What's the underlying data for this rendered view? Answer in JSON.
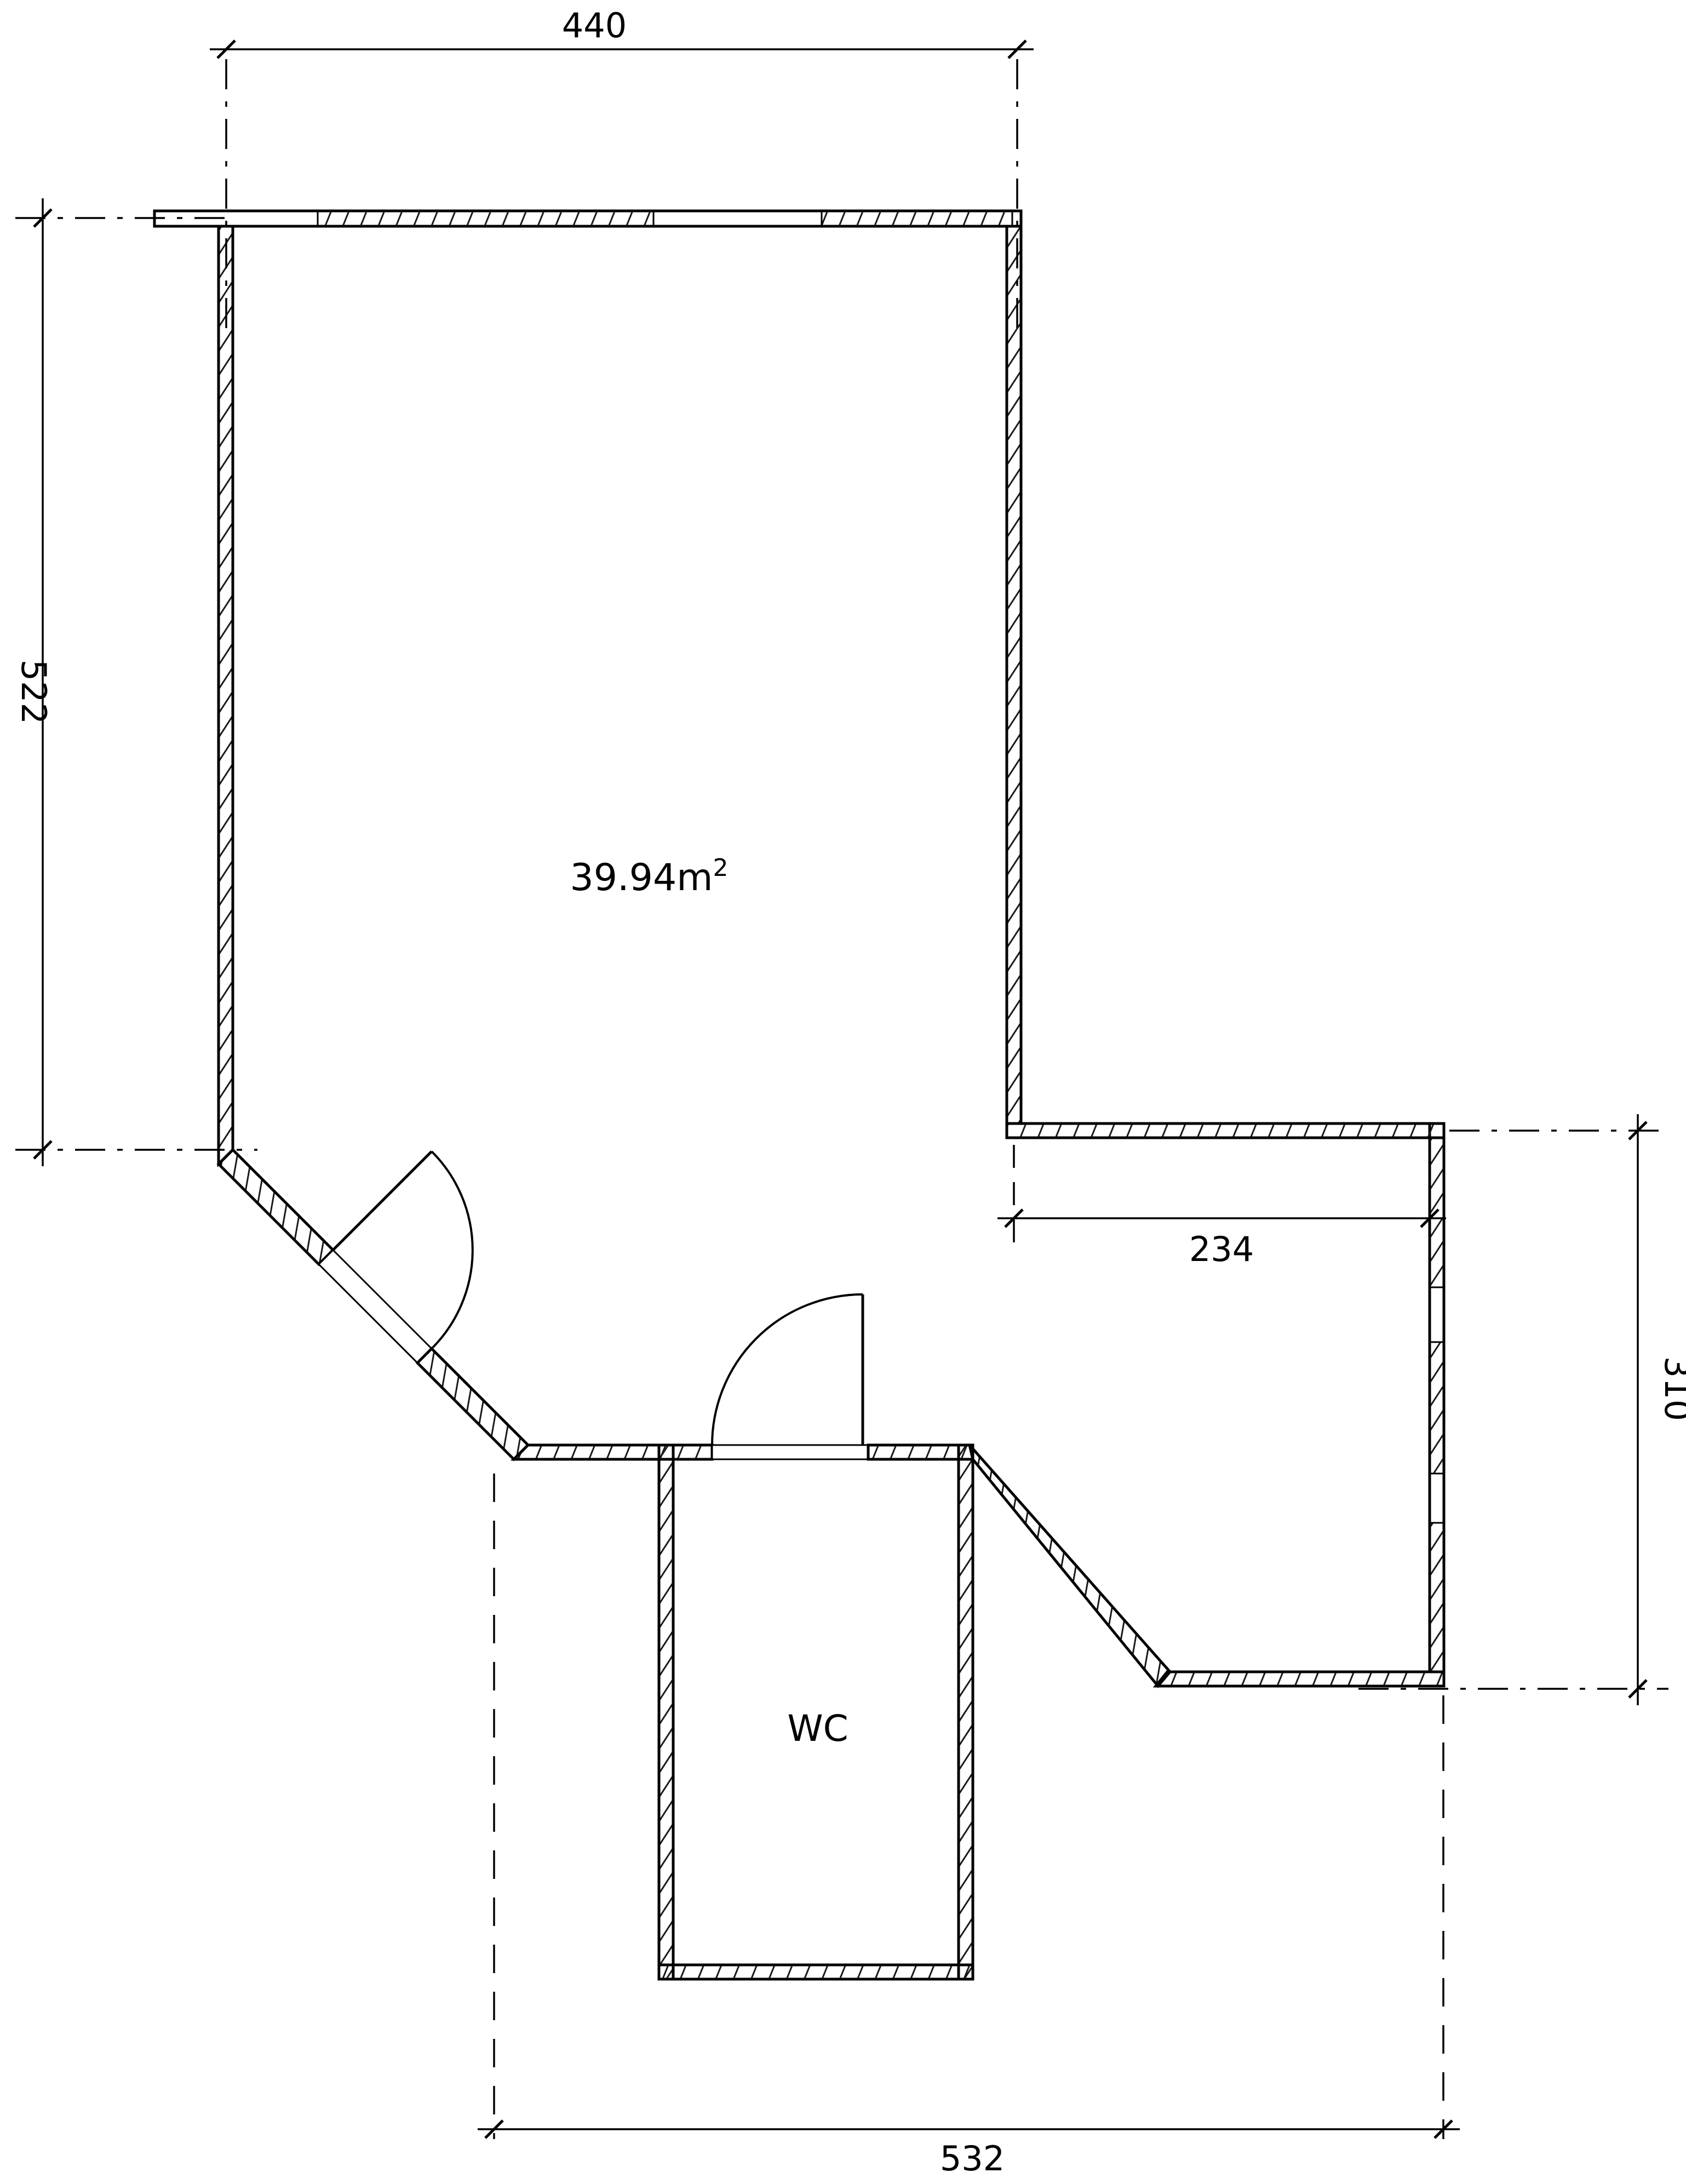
{
  "drawing": {
    "type": "architectural-floor-plan",
    "area_label": {
      "text": "39.94m",
      "sup": "2"
    },
    "room_label": "WC",
    "dimensions": {
      "top": "440",
      "left": "522",
      "inner_right": "234",
      "right": "310",
      "bottom": "532"
    },
    "colors": {
      "line": "#000000",
      "background": "#ffffff"
    }
  }
}
